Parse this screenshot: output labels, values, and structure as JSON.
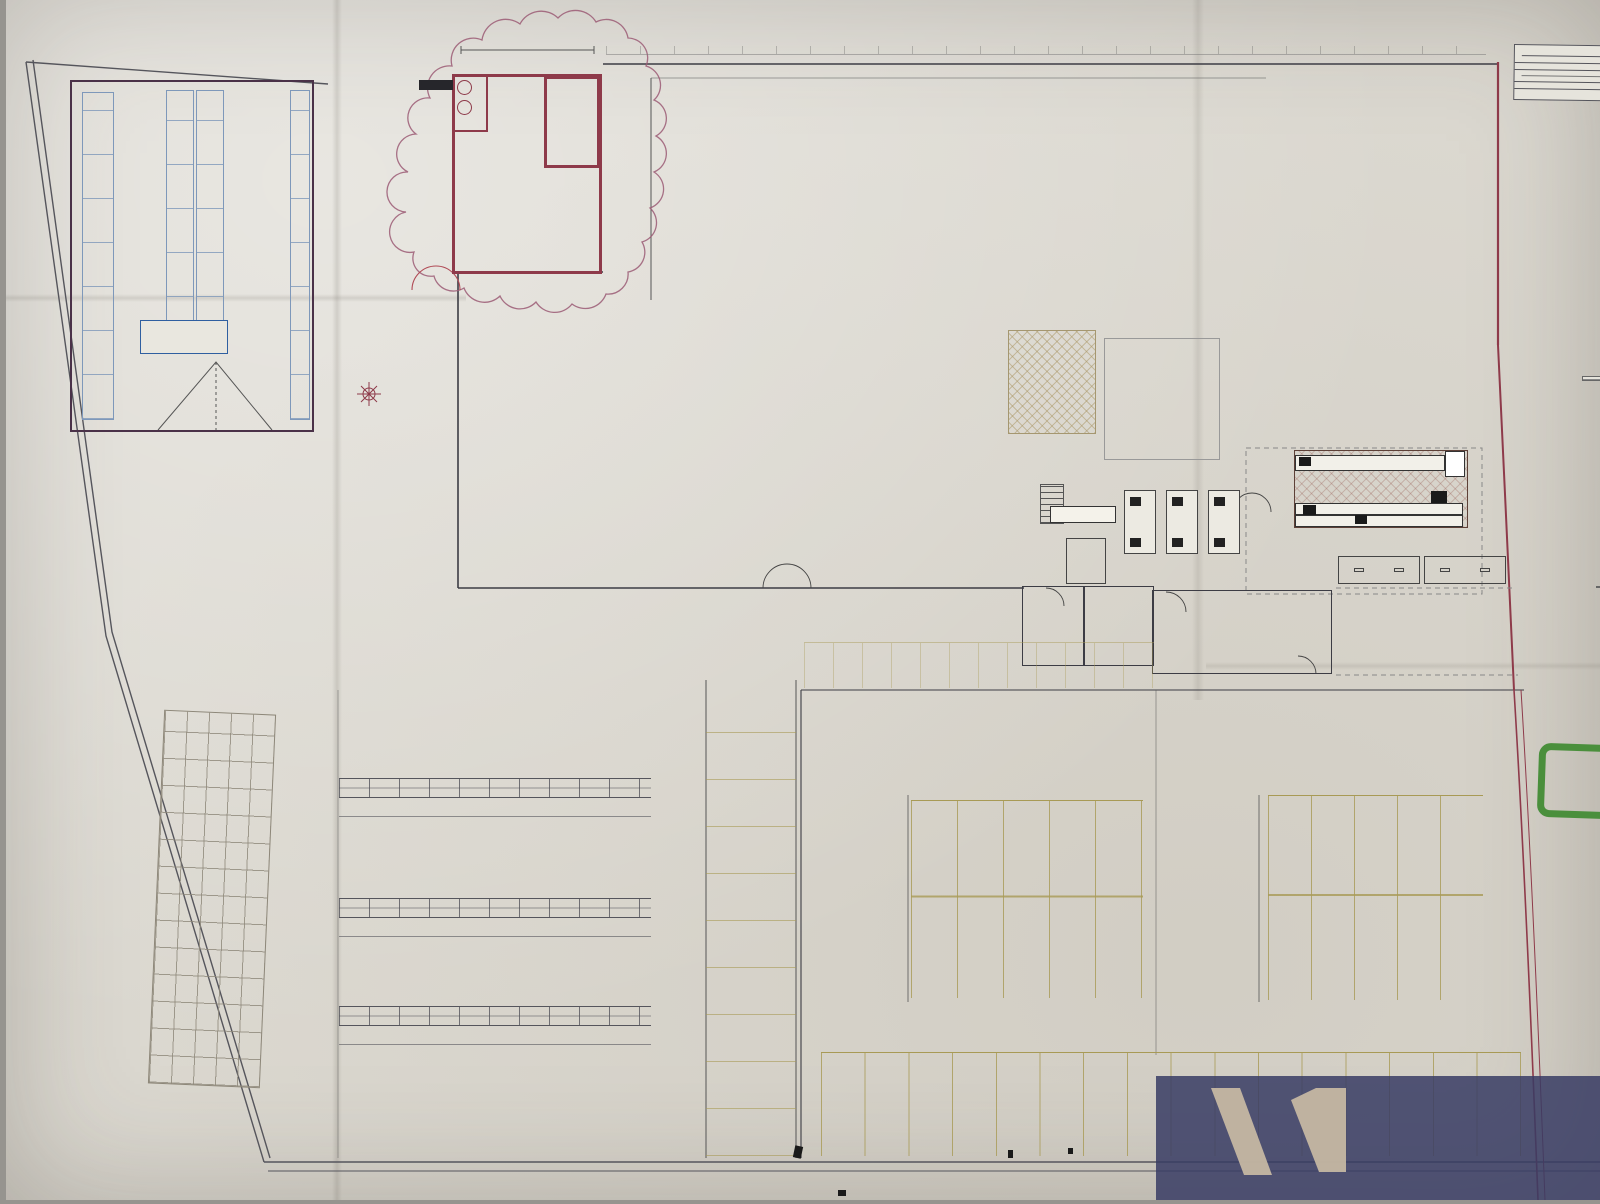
{
  "site": {
    "reserve": {
      "name": "RESERVE",
      "area": "SU : 287.60 m²",
      "door_note": "Porte Sectionnelle 450x420"
    },
    "livraison": "LIVRAISON",
    "porte_acier": "PORTE ACIER",
    "note_line1": "Porte 240x215 coulée",
    "note_line2": "Ouvertures alignée selon symétrie et axe de la porte",
    "grid_area": "104.1m²",
    "exterieur_line1": "EXTERIEUR BATI/JARDIN",
    "exterieur_line2": "1195.1 m²"
  },
  "atelier": {
    "porte": "PORTE SECTIONNELLE 3M",
    "aspiration": "ASPIRATION",
    "aspiration_area": "3.5m²",
    "sav": "SAV",
    "sav_area": "15.6m²",
    "scie": "SCIE DECOUPE",
    "scie_area": "63.5m²",
    "baie": "BAIE VITREE",
    "racks": [
      "RACK CP",
      "BOIS AGGLO",
      "SCIE A PANNEAUX",
      "RACK CHUTE VERRE",
      "RACK GRAND PANNEAU VERRE"
    ],
    "partie_vitree": "PARTIE VITREE"
  },
  "departments": [
    {
      "label": "BOIS"
    },
    {
      "label": "QUINCAILLERIE",
      "sub": "Serrurerie"
    },
    {
      "label": "SANITAIRE"
    },
    {
      "label": "DROGUERIE"
    },
    {
      "label": "PEINTURE"
    },
    {
      "label": "JARDIN"
    },
    {
      "label": "OUTILLAGE"
    },
    {
      "label": "ELECTRICITE"
    }
  ],
  "areas": {
    "promo": {
      "label": "PROMO",
      "area": "44.8m²"
    },
    "magasin": {
      "l1": "MAGASIN 1696.4m²",
      "l2": "Bricolage 1548.7m²",
      "l3": "Bati 147.7 m²"
    },
    "deco": {
      "label": "Espace Décoration",
      "area": "31.6m² / 32ml",
      "tc": "T.C.",
      "r1": "RIDEAUX VOILAGES",
      "r2": "RIDEAUX VOILAGES BRISE BISE",
      "pp": [
        "P.P.",
        "P.P.",
        "P.P.",
        "P.P.",
        "P.P.",
        "P.P."
      ],
      "pp2": [
        "P.P.",
        "P.P.",
        "P.P.",
        "P.P.",
        "P.P.",
        "P.P.",
        "P.P."
      ]
    },
    "pvc": "PVC",
    "moquette": "Moquette",
    "dem": "DEM",
    "h490": "H490",
    "espace_carte": "Espace Carte",
    "location_l1": "Location",
    "location_l2": "Matériels",
    "location_area": "7.2m²",
    "sas": {
      "label": "SAS",
      "area": "47.4m²"
    },
    "zone_expo": "ZONE EXPO",
    "zone_expo_b": {
      "label": "ZONE EXPO",
      "area": "90.5m²"
    },
    "bati": {
      "label": "BATI",
      "area": "35.4ml"
    },
    "small": {
      "a152": "15.2m²",
      "a45": "4.5m²",
      "a4": "4m²",
      "a134": "13.4m²",
      "a146": "14.6m²",
      "a29": "2.9m²",
      "a18": "1.8m²",
      "a28": "2.8m²",
      "a44": "4.4m²"
    }
  },
  "rack_labels": {
    "bois": [
      "ECHELLE ESCALIER",
      "ACC LAMBRIS",
      "PLANCHER",
      "REVETEMENT DROITE",
      "LAMBRIS BOIS",
      "LAMBRIS PVC",
      "PLANCHE RABOTE",
      "PLANCHE BRUT",
      "RIDEAUX AU BESOINS"
    ],
    "quinc": [
      "Etagère & émoirs de rangement",
      "Tablette murale",
      "Plaques & poignées",
      "Boulons",
      "Pointes",
      "Poulies aux lettres",
      "Fer & profilé",
      "Corde & chaîne",
      "Clouterie / Visserie",
      "RIDEAUX DOUCHES / TAPIS SDB"
    ],
    "drog": [
      "DROGUERIE",
      "BROSSERIE",
      "DALLE DE PLAFONDS",
      "ATTENTION PROFONDEUR MUR",
      "PAILLASSON",
      "PASSAGE",
      "ISOL. MINCE",
      "OUTILLAGE DE DECORATION",
      "LIQUIDE",
      "ADHESIF",
      "COLLE",
      "REPARATION",
      "MURALE",
      "CREPIS INT",
      "SOUS COUCHE",
      "BOISERIE",
      "AEROSOL",
      "PLAFONDS",
      "MURS ET PLAFONDS",
      "PT CDT",
      "GR CDT"
    ],
    "peint": [
      "BASES",
      "FACADE",
      "BOIS FER SOL",
      "MAT"
    ],
    "mid": [
      "ESCABEAUX",
      "SOUDURE",
      "CASIERS A VIS",
      "ACC CHEMINEE",
      "RAMONAGE",
      "PRODUITS PISCINES",
      "CONTENANTS",
      "EQUIPEMENT DU JARDIN",
      "GANTS / SECURITE",
      "ARROSAGE",
      "AMPOULES",
      "LUMINAIRE"
    ],
    "header": [
      "PLAN DE TRAVAIL",
      "AMENAGEMENT PLACARD ET STOCK PORTE",
      "Sécheur",
      "RIDEAUX + BAIGNOIRES",
      "ROBINETTERIE"
    ]
  },
  "legend": {
    "title": "RECAPITULAT",
    "lines": [
      "01 - QUINCAILLERIE",
      "64 ml + 9 ml de rack",
      "02 - OUTILLAGE",
      "49 ml + 15 ml de rac",
      "03 - ELECTRICITE",
      "72 ml + podiums",
      "04 - SANITAIRE / C",
      "65 ml + 33 ml de rac",
      "05 - DROGUERIE /",
      "151 ml + podiums",
      "05 - DECORATION",
      "Espace décoration +",
      "06 - BOIS",
      "3 ml + 80 ml de rack",
      "08 - JARDIN",
      "52 ml + 12 ml de rac"
    ],
    "total1": "TOTAL LINEAIRE",
    "divers_title": "DIVERS",
    "divers": [
      "03 - ELECTRICITE",
      "Espace luminaire +",
      "Grille luminaire =",
      "05 - MOQUETTES",
      "2 dérouleurs",
      "07 - MATERIAUX",
      "32.7 ml de racks",
      "07 - MATERIAUX",
      "132 ml de racks",
      "08 - JARDIN",
      "Location Matéri"
    ],
    "total2": "TOTAL PODIU",
    "t2_header": "LE",
    "t2_rows": [
      "SU",
      "MA",
      "SA",
      "EX",
      "BAT",
      "TOT",
      "AUT",
      "BUR",
      "SCI",
      "SAV",
      "LOC",
      "RES",
      "SHO",
      "SHO",
      "PLA"
    ],
    "t3_rows": [
      "A",
      "B",
      "C",
      "D",
      "E",
      "F",
      "G",
      "H",
      "I"
    ]
  },
  "parking": {
    "row0": [
      "1",
      "2",
      "3",
      "4",
      "5",
      "6",
      "7",
      "8",
      "9",
      "10",
      "11",
      "12"
    ],
    "r1l": [
      "13",
      "14",
      "15",
      "16",
      "17"
    ],
    "r1r": [
      "18",
      "19",
      "20",
      "21",
      "22"
    ],
    "r2l": [
      "30",
      "31",
      "32",
      "33",
      "34"
    ],
    "r2r": [
      "35",
      "36",
      "37",
      "38",
      "39"
    ],
    "r3": [
      "47",
      "48",
      "49",
      "50",
      "51",
      "52",
      "53",
      "54",
      "55",
      "56",
      "57",
      "58",
      "59",
      "60",
      "61",
      "62"
    ]
  },
  "logos": {
    "brand": "Mr.Bricolage",
    "heart": "♥",
    "mon1": "MONNEREAU",
    "mon2": "IMMOBILIER"
  },
  "colors": {
    "wall": "#8e3a4a",
    "dept": "#a63a4e",
    "blue": "#2f5fa0",
    "green": "#46823a",
    "navy": "#3a3f69",
    "brand": "#a3334b",
    "olive": "#a89a55"
  }
}
